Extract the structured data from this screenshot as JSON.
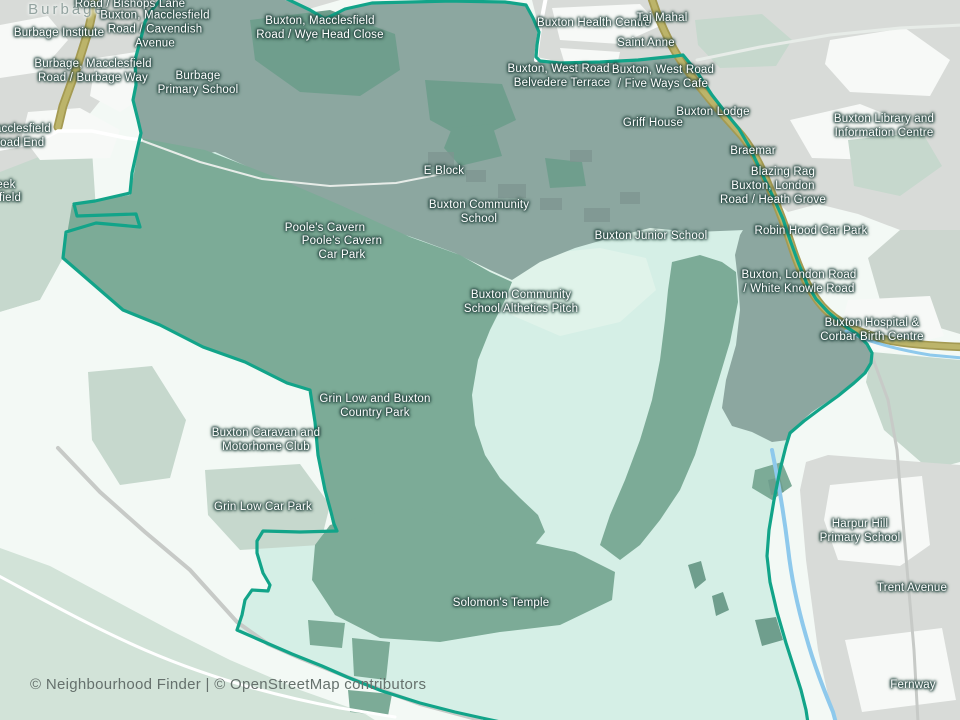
{
  "map": {
    "attribution": "© Neighbourhood Finder | © OpenStreetMap contributors",
    "colors": {
      "bg": "#ecf4ef",
      "outside_pale": "#f3f9f5",
      "outside_green": "#c6d8cd",
      "bottom_green": "#d2e3d8",
      "urban": "#d8dbd8",
      "urban_soft": "#ccd6cf",
      "white_patch": "#f7f9f7",
      "mint": "#d5efe6",
      "mint_light": "#e0f3ea",
      "clearing": "#cfeae0",
      "campus": "#8ca7a0",
      "park": "#7cab97",
      "tree": "#6f9e8d",
      "building": "#7e9490",
      "boundary": "#12a489",
      "water": "#8ec9ec",
      "road_primary": "#bcb46a",
      "road_casing": "#a49a52",
      "road_white": "#ffffff",
      "road_gray": "#c7cac7",
      "label_text": "#ffffff",
      "label_halo": "rgba(44,76,70,0.85)",
      "place_label": "#93a3a0",
      "attribution_text": "#65706c"
    },
    "labels": [
      {
        "kind": "place",
        "x": 67,
        "y": 10,
        "lines": [
          "Burbage"
        ]
      },
      {
        "kind": "poi",
        "x": 130,
        "y": 5,
        "lines": [
          "Road / Bishops Lane"
        ]
      },
      {
        "kind": "poi",
        "x": 155,
        "y": 30,
        "lines": [
          "Buxton, Macclesfield",
          "Road / Cavendish",
          "Avenue"
        ]
      },
      {
        "kind": "poi",
        "x": 59,
        "y": 34,
        "lines": [
          "Burbage Institute"
        ]
      },
      {
        "kind": "poi",
        "x": 320,
        "y": 29,
        "lines": [
          "Buxton, Macclesfield",
          "Road / Wye Head Close"
        ]
      },
      {
        "kind": "poi",
        "x": 93,
        "y": 72,
        "lines": [
          "Burbage, Macclesfield",
          "Road / Burbage Way"
        ]
      },
      {
        "kind": "poi",
        "x": 198,
        "y": 84,
        "lines": [
          "Burbage",
          "Primary School"
        ]
      },
      {
        "kind": "poi",
        "x": 18,
        "y": 137,
        "lines": [
          "Macclesfield",
          "Road End"
        ]
      },
      {
        "kind": "poi",
        "x": 6,
        "y": 186,
        "lines": [
          "eek"
        ]
      },
      {
        "kind": "poi",
        "x": 10,
        "y": 199,
        "lines": [
          "field"
        ]
      },
      {
        "kind": "poi",
        "x": 594,
        "y": 24,
        "lines": [
          "Buxton Health Centre"
        ]
      },
      {
        "kind": "poi",
        "x": 662,
        "y": 19,
        "lines": [
          "Taj Mahal"
        ]
      },
      {
        "kind": "poi",
        "x": 646,
        "y": 44,
        "lines": [
          "Saint Anne"
        ]
      },
      {
        "kind": "poi",
        "x": 562,
        "y": 77,
        "lines": [
          "Buxton, West Road /",
          "Belvedere Terrace"
        ]
      },
      {
        "kind": "poi",
        "x": 663,
        "y": 78,
        "lines": [
          "Buxton, West Road",
          "/ Five Ways Cafe"
        ]
      },
      {
        "kind": "poi",
        "x": 713,
        "y": 113,
        "lines": [
          "Buxton Lodge"
        ]
      },
      {
        "kind": "poi",
        "x": 653,
        "y": 124,
        "lines": [
          "Griff House"
        ]
      },
      {
        "kind": "poi",
        "x": 884,
        "y": 127,
        "lines": [
          "Buxton Library and",
          "Information Centre"
        ]
      },
      {
        "kind": "poi",
        "x": 753,
        "y": 152,
        "lines": [
          "Braemar"
        ]
      },
      {
        "kind": "poi",
        "x": 783,
        "y": 173,
        "lines": [
          "Blazing Rag"
        ]
      },
      {
        "kind": "poi",
        "x": 773,
        "y": 194,
        "lines": [
          "Buxton, London",
          "Road / Heath Grove"
        ]
      },
      {
        "kind": "poi",
        "x": 811,
        "y": 232,
        "lines": [
          "Robin Hood Car Park"
        ]
      },
      {
        "kind": "poi",
        "x": 444,
        "y": 172,
        "lines": [
          "E Block"
        ]
      },
      {
        "kind": "poi",
        "x": 479,
        "y": 213,
        "lines": [
          "Buxton Community",
          "School"
        ]
      },
      {
        "kind": "poi",
        "x": 325,
        "y": 229,
        "lines": [
          "Poole's Cavern"
        ]
      },
      {
        "kind": "poi",
        "x": 342,
        "y": 249,
        "lines": [
          "Poole's Cavern",
          "Car Park"
        ]
      },
      {
        "kind": "poi",
        "x": 651,
        "y": 237,
        "lines": [
          "Buxton Junior School"
        ]
      },
      {
        "kind": "poi",
        "x": 521,
        "y": 303,
        "lines": [
          "Buxton Community",
          "School Althetics Pitch"
        ]
      },
      {
        "kind": "poi",
        "x": 799,
        "y": 283,
        "lines": [
          "Buxton, London Road",
          "/ White Knowle Road"
        ]
      },
      {
        "kind": "poi",
        "x": 872,
        "y": 331,
        "lines": [
          "Buxton Hospital &",
          "Corbar Birth Centre"
        ]
      },
      {
        "kind": "poi",
        "x": 375,
        "y": 407,
        "lines": [
          "Grin Low and Buxton",
          "Country Park"
        ]
      },
      {
        "kind": "poi",
        "x": 266,
        "y": 441,
        "lines": [
          "Buxton Caravan and",
          "Motorhome Club"
        ]
      },
      {
        "kind": "poi",
        "x": 263,
        "y": 508,
        "lines": [
          "Grin Low Car Park"
        ]
      },
      {
        "kind": "poi",
        "x": 501,
        "y": 604,
        "lines": [
          "Solomon's Temple"
        ]
      },
      {
        "kind": "poi",
        "x": 860,
        "y": 532,
        "lines": [
          "Harpur Hill",
          "Primary School"
        ]
      },
      {
        "kind": "poi",
        "x": 912,
        "y": 589,
        "lines": [
          "Trent Avenue"
        ]
      },
      {
        "kind": "poi",
        "x": 913,
        "y": 686,
        "lines": [
          "Fernway"
        ]
      }
    ]
  }
}
